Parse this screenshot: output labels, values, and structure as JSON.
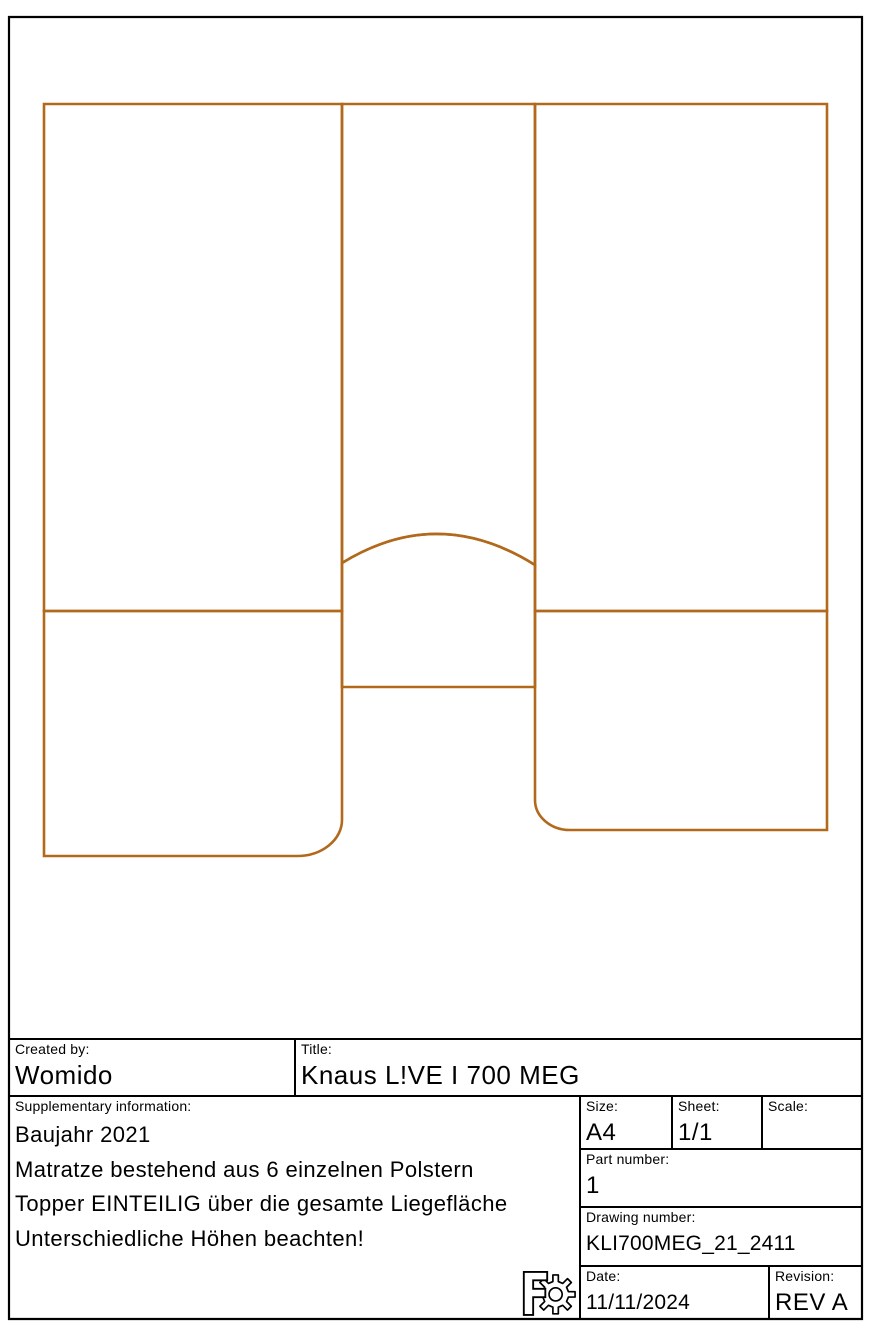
{
  "drawing": {
    "stroke_color": "#b2691c",
    "description": "Mattress cushion layout, 6 pieces",
    "icons": {
      "logo": "freecad-gear-logo"
    }
  },
  "title_block": {
    "created_by": {
      "label": "Created by:",
      "value": "Womido"
    },
    "title": {
      "label": "Title:",
      "value": "Knaus L!VE I 700 MEG"
    },
    "supplementary": {
      "label": "Supplementary information:",
      "lines": [
        "Baujahr 2021",
        "Matratze bestehend aus 6 einzelnen Polstern",
        "Topper EINTEILIG über die gesamte Liegefläche",
        "Unterschiedliche Höhen beachten!"
      ]
    },
    "size": {
      "label": "Size:",
      "value": "A4"
    },
    "sheet": {
      "label": "Sheet:",
      "value": "1/1"
    },
    "scale": {
      "label": "Scale:",
      "value": ""
    },
    "part_number": {
      "label": "Part number:",
      "value": "1"
    },
    "drawing_number": {
      "label": "Drawing number:",
      "value": "KLI700MEG_21_2411"
    },
    "date": {
      "label": "Date:",
      "value": "11/11/2024"
    },
    "revision": {
      "label": "Revision:",
      "value": "REV A"
    }
  }
}
